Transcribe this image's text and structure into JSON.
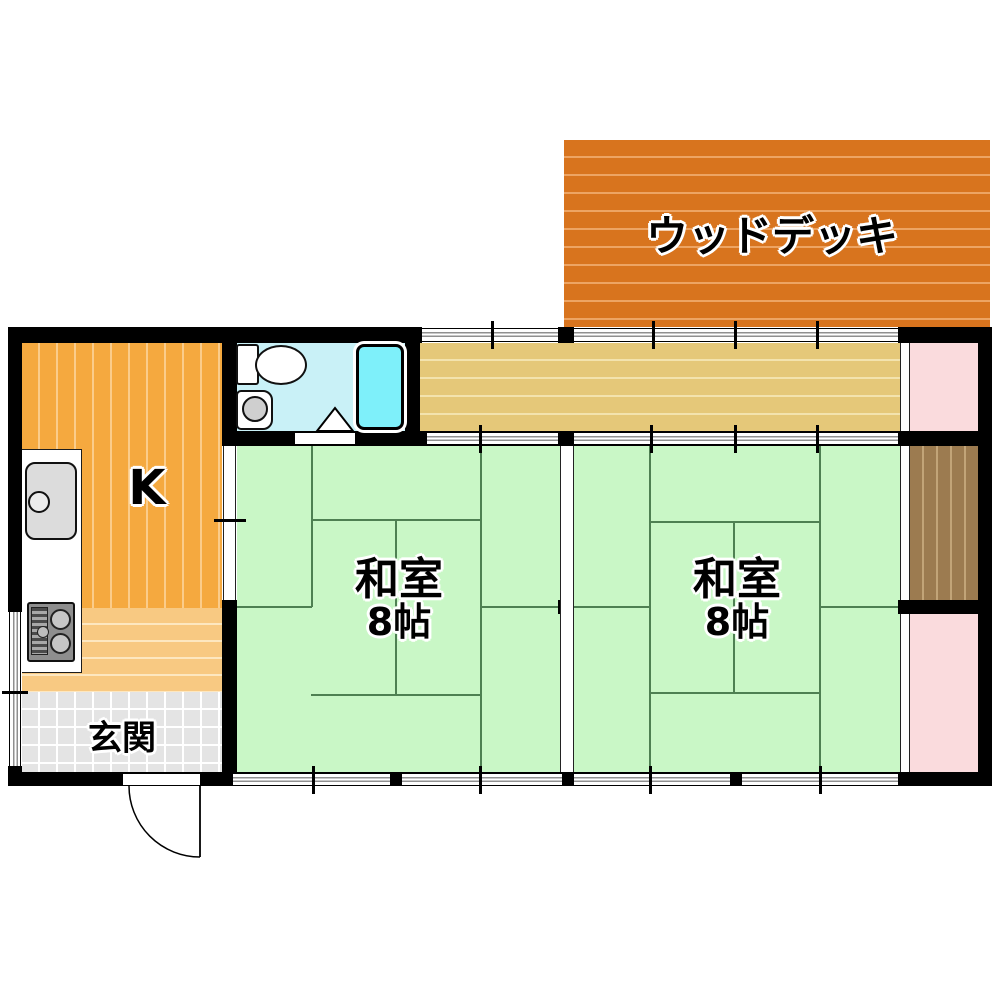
{
  "floorplan": {
    "wood_deck": {
      "label": "ウッドデッキ"
    },
    "kitchen": {
      "label": "K"
    },
    "entrance": {
      "label": "玄関"
    },
    "tatami_rooms": [
      {
        "name": "和室",
        "size": "8帖"
      },
      {
        "name": "和室",
        "size": "8帖"
      }
    ],
    "colors": {
      "wood_deck": "#d8741e",
      "kitchen_floor": "#f5a93f",
      "kitchen_lower_floor": "#f8c982",
      "corridor": "#e5c879",
      "tatami": "#c9f7c6",
      "entrance_tile": "#e4e4e4",
      "bathroom_floor": "#c9f1f7",
      "bathtub": "#7ef0fa",
      "closet_brown": "#9c7b50",
      "closet_pink": "#fadbdd",
      "wall": "#000000"
    }
  }
}
